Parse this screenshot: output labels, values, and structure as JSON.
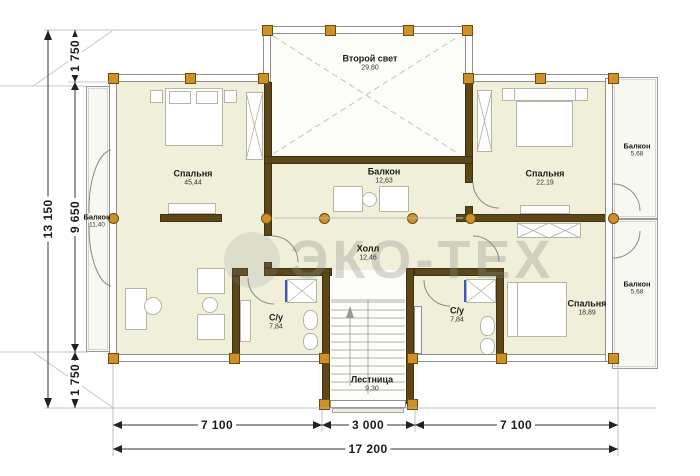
{
  "watermark": {
    "text": "ЭКО-ТЕХ"
  },
  "rooms": [
    {
      "id": "second-light",
      "name": "Второй свет",
      "area": "29,80"
    },
    {
      "id": "bedroom-large",
      "name": "Спальня",
      "area": "45,44"
    },
    {
      "id": "inner-balcony",
      "name": "Балкон",
      "area": "12,63"
    },
    {
      "id": "bedroom-right-top",
      "name": "Спальня",
      "area": "22,19"
    },
    {
      "id": "balcony-right-top",
      "name": "Балкон",
      "area": "5,68"
    },
    {
      "id": "balcony-left",
      "name": "Балкон",
      "area": "11,40"
    },
    {
      "id": "hall",
      "name": "Холл",
      "area": "12,46"
    },
    {
      "id": "balcony-right-bottom",
      "name": "Балкон",
      "area": "5,68"
    },
    {
      "id": "bathroom-left",
      "name": "С/у",
      "area": "7,84"
    },
    {
      "id": "bathroom-right",
      "name": "С/у",
      "area": "7,84"
    },
    {
      "id": "bedroom-right-bottom",
      "name": "Спальня",
      "area": "18,89"
    },
    {
      "id": "stairs",
      "name": "Лестница",
      "area": "9,30"
    }
  ],
  "dimensions": {
    "left_total": "13 150",
    "left_top": "1 750",
    "left_middle": "9 650",
    "left_bottom": "1 750",
    "bottom_left": "7 100",
    "bottom_center": "3 000",
    "bottom_right": "7 100",
    "bottom_total": "17 200"
  },
  "colors": {
    "floor": "#f0efda",
    "wall_dark": "#5b4718",
    "column": "#cf9125",
    "shower_accent": "#3a57c9",
    "balcony_floor": "#f8f8f3"
  }
}
